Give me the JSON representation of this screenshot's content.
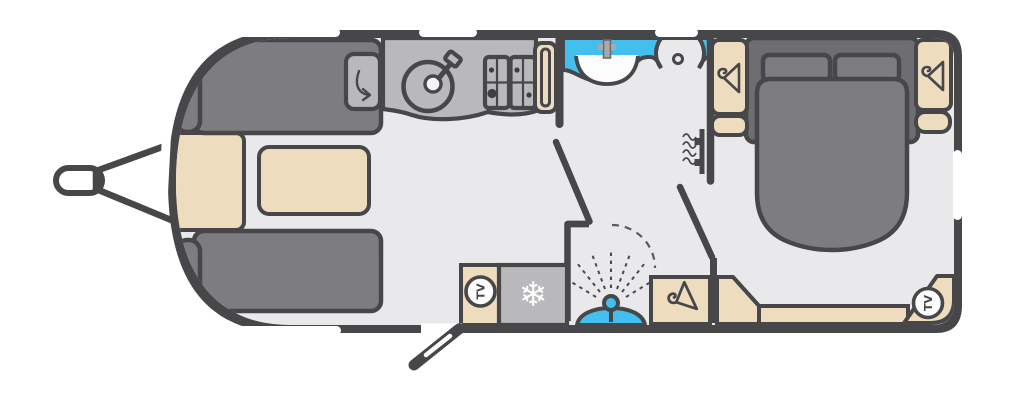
{
  "title": "Caravan floorplan - front lounge, centre kitchen, washroom, rear island bed",
  "labels": {
    "tv": "TV",
    "snowflake": "❄"
  },
  "colors": {
    "wall": "#47474a",
    "floor": "#e9e9eb",
    "upholstery": "#7d7d81",
    "upholstery_dark": "#6e6e71",
    "cabinet_cream": "#eddcbe",
    "worktop_grey": "#b9b9bc",
    "water_blue": "#42bfee",
    "window_white": "#ffffff"
  },
  "rooms": {
    "lounge": {
      "name": "front lounge",
      "features": [
        "front chest",
        "two facing sofas",
        "centre table",
        "storage box with lift arrow"
      ]
    },
    "kitchen": {
      "name": "kitchen",
      "features": [
        "round sink with tap",
        "four burner hob",
        "tall unit with slot",
        "fridge freezer",
        "TV point"
      ]
    },
    "washroom": {
      "name": "washroom",
      "features": [
        "vanity basin with tap",
        "toilet with flush button",
        "wall heater",
        "shower with spray head",
        "door swing arc"
      ]
    },
    "bedroom": {
      "name": "rear bedroom",
      "features": [
        "island bed with two pillows",
        "two head wardrobes",
        "foot wardrobe",
        "angled corner unit",
        "rear shelf",
        "corner TV point"
      ]
    }
  },
  "exterior": {
    "hitch": "tow hitch with A-frame",
    "entrance_door": "open door with window",
    "window_count": 8
  }
}
